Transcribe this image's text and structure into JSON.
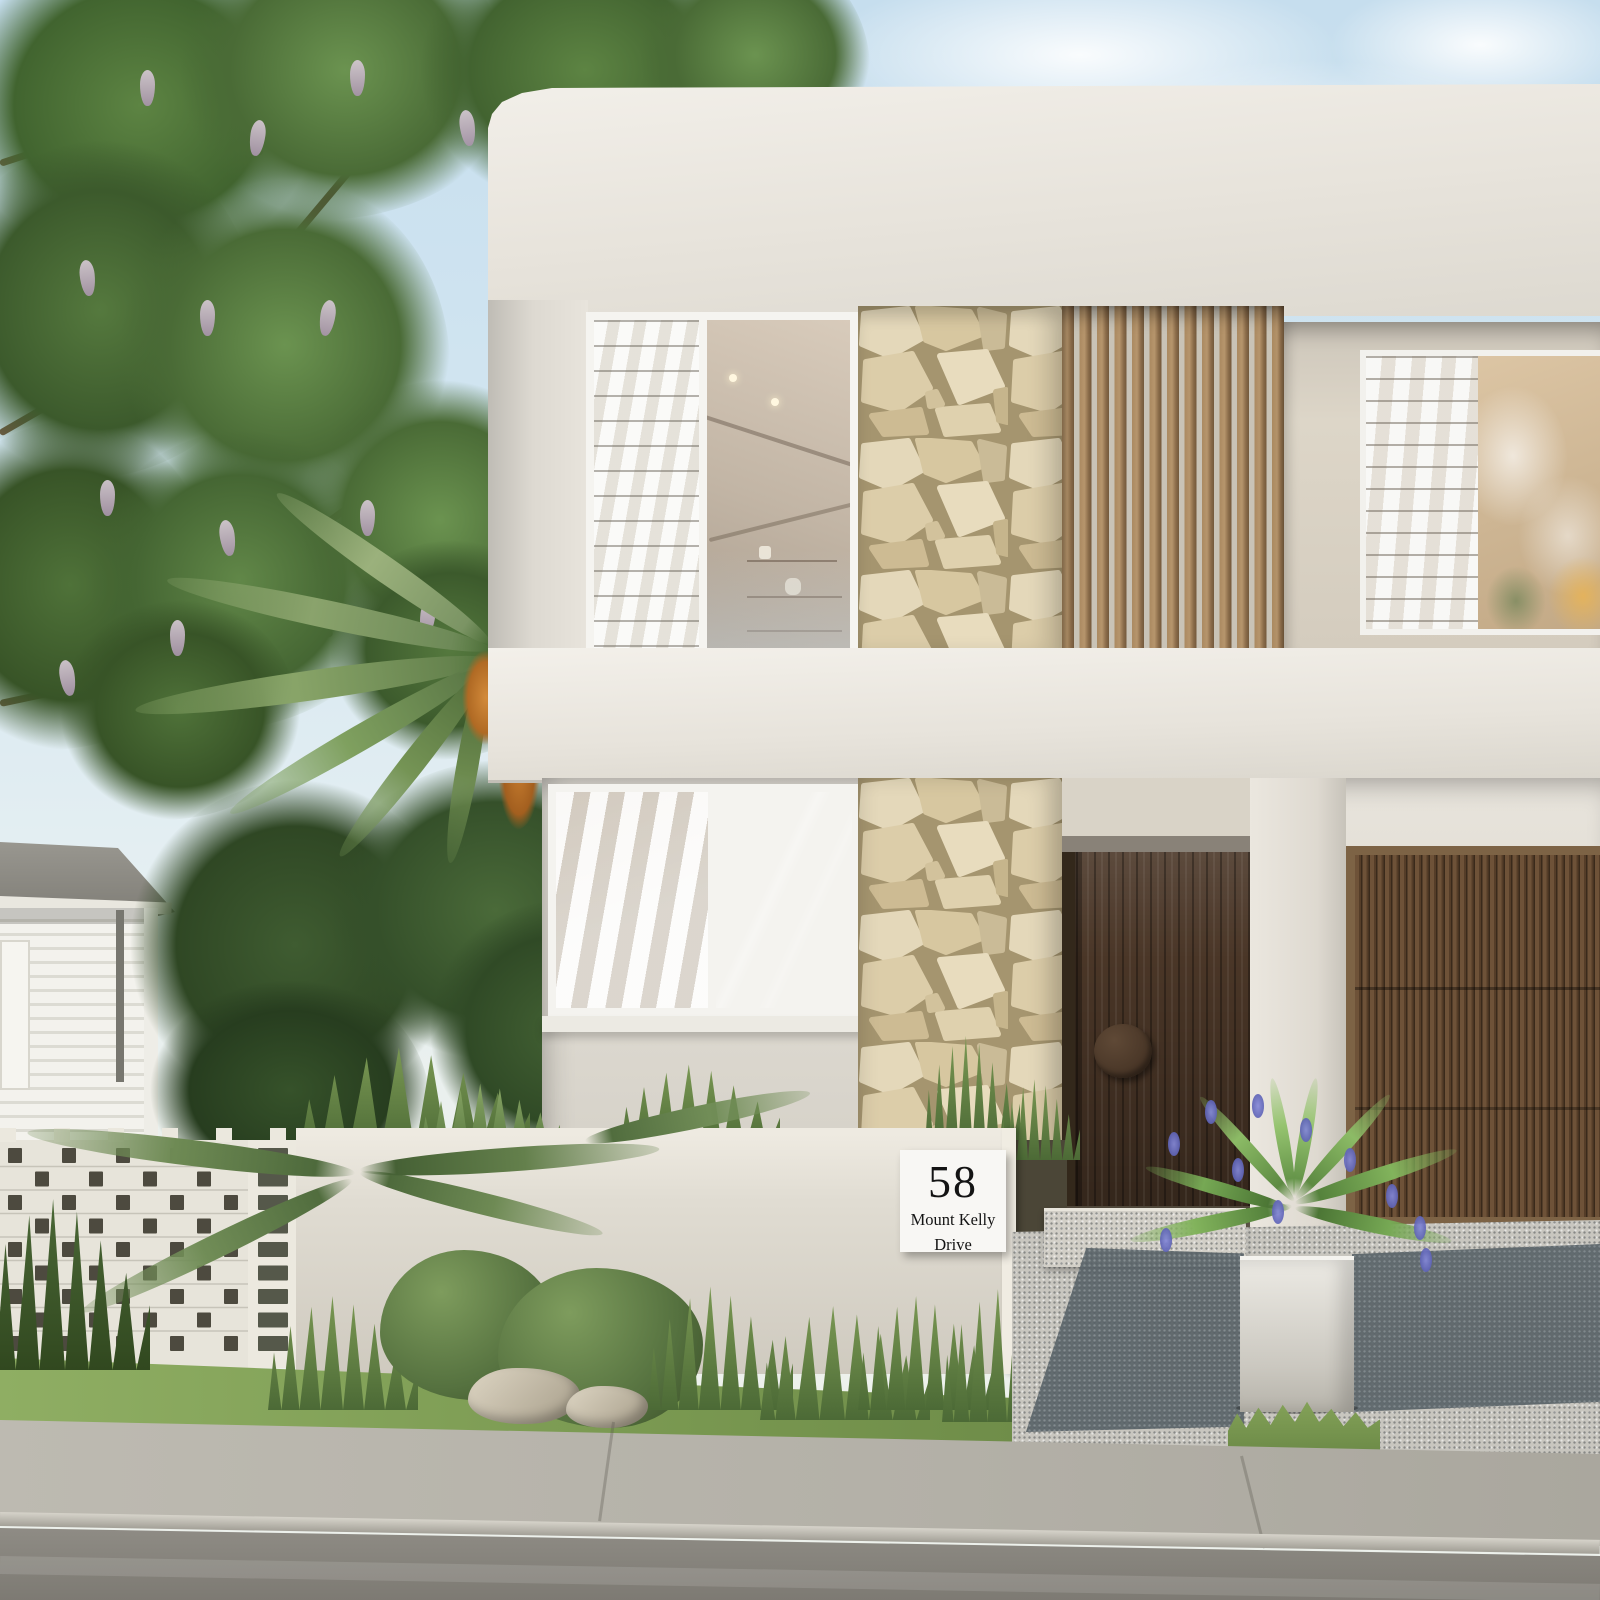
{
  "scene": {
    "type": "photorealistic architectural exterior render",
    "description": "Modern two-storey white rendered home with sandstone feature pillar, timber slat screen, timber entry door and battened garage door; flowering street tree, palm and cycad, breeze-block and rendered front fence, landscaped garden, exposed-aggregate driveway with planter, concrete footpath and asphalt road",
    "house_number_sign": {
      "number": "58",
      "street_line_1": "Mount Kelly",
      "street_line_2": "Drive"
    },
    "palette": {
      "sky": "#cde1ee",
      "render_white": "#e9e5dd",
      "render_shadow": "#d6d2c9",
      "stone_beige": "#dccda9",
      "stone_grout": "#a5956f",
      "timber_slat": "#a9875e",
      "entry_door": "#4a3627",
      "garage_battens": "#553d28",
      "foliage_green": "#5d8443",
      "wisteria_mauve": "#c0afc2",
      "agapanthus_blue": "#5c63c0",
      "grass": "#85a45c",
      "driveway_aggregate": "#c8c6bf",
      "driveway_shadow": "#576065",
      "footpath": "#b5b2a9",
      "road": "#86837c",
      "plaque_white": "#f8f7f4"
    }
  }
}
